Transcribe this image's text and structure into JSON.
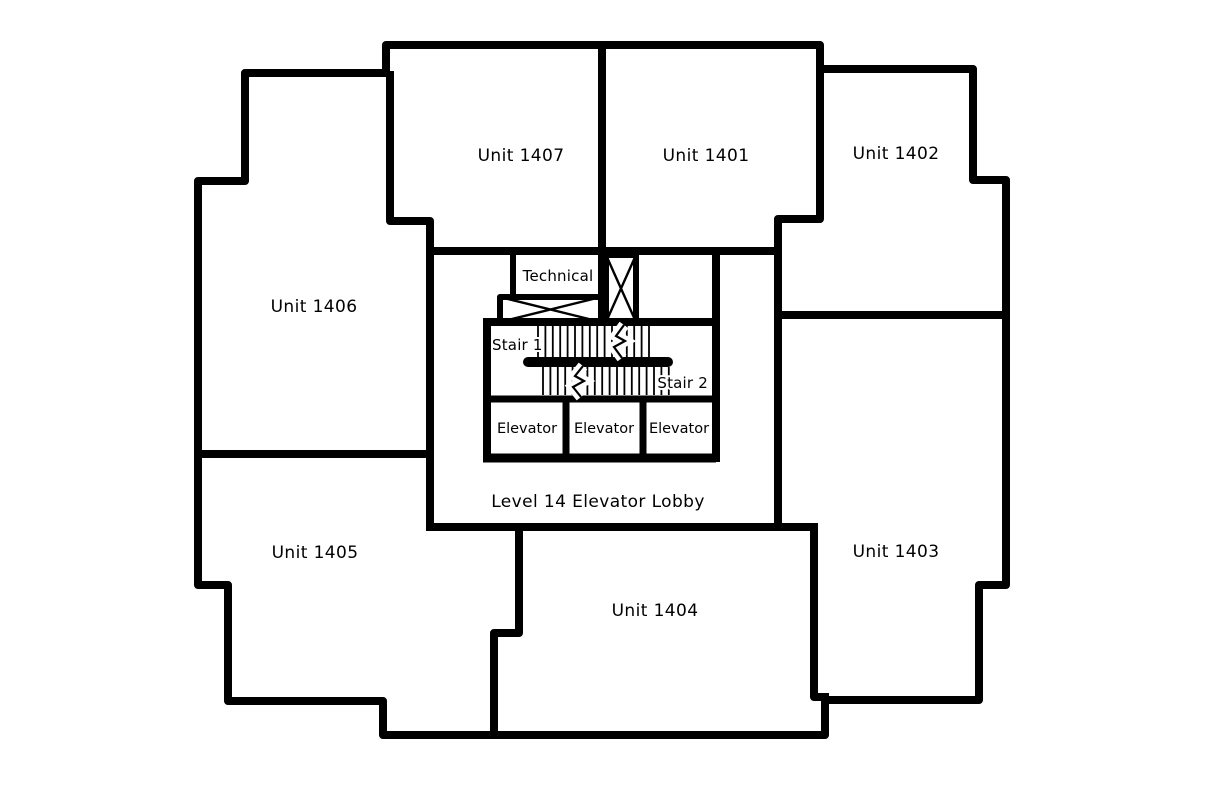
{
  "plan": {
    "units": [
      {
        "id": "unit-1407",
        "label": "Unit 1407"
      },
      {
        "id": "unit-1401",
        "label": "Unit 1401"
      },
      {
        "id": "unit-1402",
        "label": "Unit 1402"
      },
      {
        "id": "unit-1406",
        "label": "Unit 1406"
      },
      {
        "id": "unit-1405",
        "label": "Unit 1405"
      },
      {
        "id": "unit-1404",
        "label": "Unit 1404"
      },
      {
        "id": "unit-1403",
        "label": "Unit 1403"
      }
    ],
    "core": {
      "technical_label": "Technical",
      "stair1_label": "Stair 1",
      "stair2_label": "Stair 2",
      "elevators": [
        {
          "label": "Elevator"
        },
        {
          "label": "Elevator"
        },
        {
          "label": "Elevator"
        }
      ],
      "lobby_label": "Level 14 Elevator Lobby"
    },
    "colors": {
      "wall": "#000000",
      "text": "#000000",
      "background": "#ffffff"
    }
  }
}
